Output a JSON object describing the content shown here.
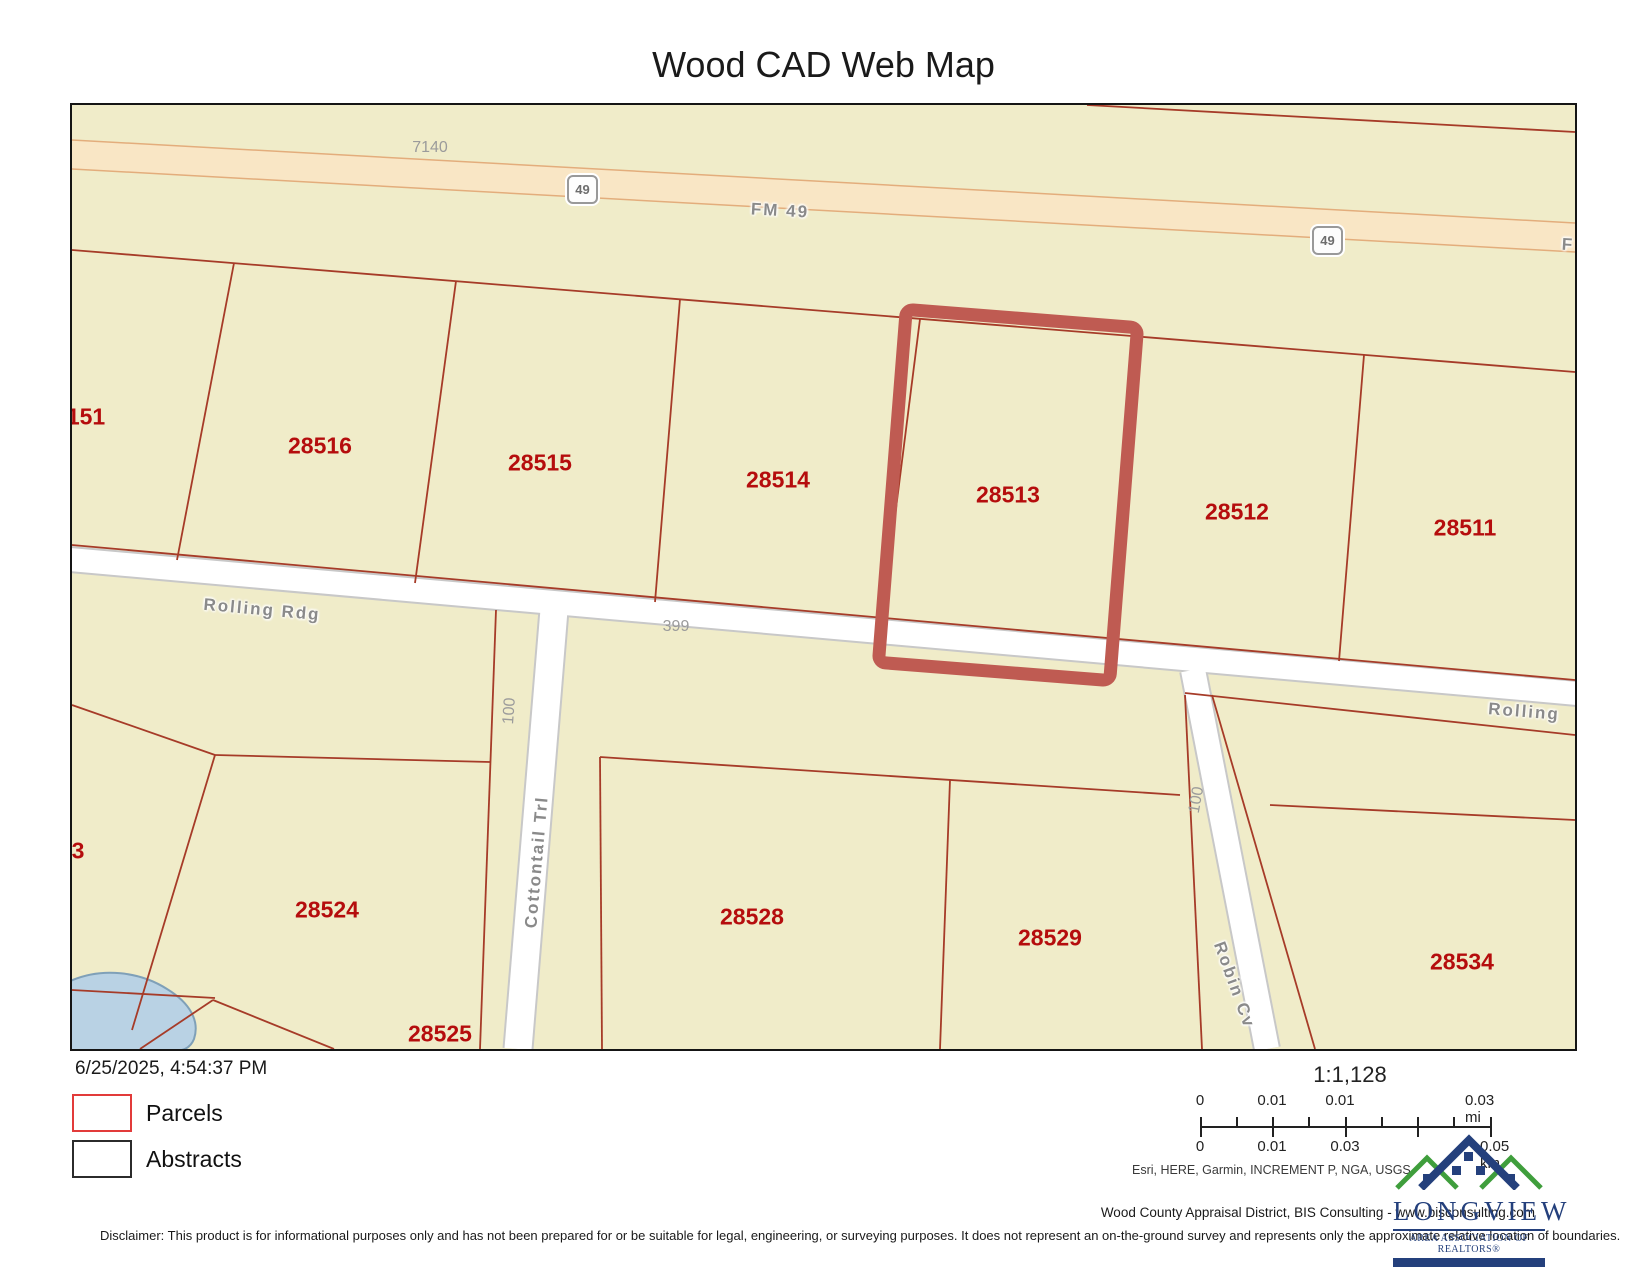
{
  "title": "Wood CAD Web Map",
  "map": {
    "highlighted_parcel": "28513",
    "parcel_labels": [
      {
        "text": "151",
        "x": 14,
        "y": 312
      },
      {
        "text": "28516",
        "x": 248,
        "y": 341
      },
      {
        "text": "28515",
        "x": 468,
        "y": 358
      },
      {
        "text": "28514",
        "x": 706,
        "y": 375
      },
      {
        "text": "28513",
        "x": 936,
        "y": 390
      },
      {
        "text": "28512",
        "x": 1165,
        "y": 407
      },
      {
        "text": "28511",
        "x": 1393,
        "y": 423
      },
      {
        "text": "3",
        "x": 6,
        "y": 746
      },
      {
        "text": "28524",
        "x": 255,
        "y": 805
      },
      {
        "text": "28525",
        "x": 368,
        "y": 929
      },
      {
        "text": "28528",
        "x": 680,
        "y": 812
      },
      {
        "text": "28529",
        "x": 978,
        "y": 833
      },
      {
        "text": "28534",
        "x": 1390,
        "y": 857
      }
    ],
    "lot_number_labels": [
      {
        "text": "7140",
        "x": 358,
        "y": 43,
        "rot": 0
      },
      {
        "text": "399",
        "x": 604,
        "y": 522,
        "rot": 0
      },
      {
        "text": "100",
        "x": 438,
        "y": 606,
        "rot": -86
      },
      {
        "text": "100",
        "x": 1125,
        "y": 695,
        "rot": -80
      }
    ],
    "road_labels": [
      {
        "text": "FM  49",
        "x": 708,
        "y": 106,
        "rot": 3.2
      },
      {
        "text": "F",
        "x": 1496,
        "y": 140,
        "rot": 3.2
      },
      {
        "text": "Rolling  Rdg",
        "x": 190,
        "y": 505,
        "rot": 5.1
      },
      {
        "text": "Rolling",
        "x": 1452,
        "y": 607,
        "rot": 4.5
      },
      {
        "text": "Cottontail  Trl",
        "x": 465,
        "y": 757,
        "rot": -85
      },
      {
        "text": "Robin  Cv",
        "x": 1162,
        "y": 880,
        "rot": 70
      }
    ],
    "shields": [
      {
        "text": "49",
        "x": 508,
        "y": 82
      },
      {
        "text": "49",
        "x": 1253,
        "y": 133
      }
    ],
    "colors": {
      "land": "#f0ecc9",
      "highway_fill": "#f9e6c5",
      "highway_edge": "#e3ad7c",
      "road_fill": "#ffffff",
      "road_casing": "#c8c8c8",
      "parcel_line": "#a63b28",
      "parcel_label": "#b50d0d",
      "highlight_outline": "#bf5b52",
      "water": "#b9d2e4"
    }
  },
  "footer": {
    "timestamp": "6/25/2025, 4:54:37 PM",
    "legend": [
      {
        "label": "Parcels",
        "color": "#e23b3a"
      },
      {
        "label": "Abstracts",
        "color": "#2b2b2b"
      }
    ],
    "scale": {
      "ratio": "1:1,128",
      "mi_labels": [
        "0",
        "0.01",
        "0.01",
        "0.03 mi"
      ],
      "km_labels": [
        "0",
        "0.01",
        "0.03",
        "0.05 km"
      ]
    },
    "sources": "Esri, HERE, Garmin, INCREMENT P, NGA, USGS",
    "attribution": "Wood County Appraisal District, BIS Consulting - www.bisconsulting.com",
    "disclaimer": "Disclaimer: This product is for informational purposes only and has not been prepared for or be suitable for legal, engineering, or surveying purposes. It does not represent an on-the-ground survey and represents only the approximate relative location of boundaries.",
    "logo": {
      "name": "LONGVIEW",
      "subtitle": "AREA ASSOCIATION OF REALTORS®"
    }
  }
}
